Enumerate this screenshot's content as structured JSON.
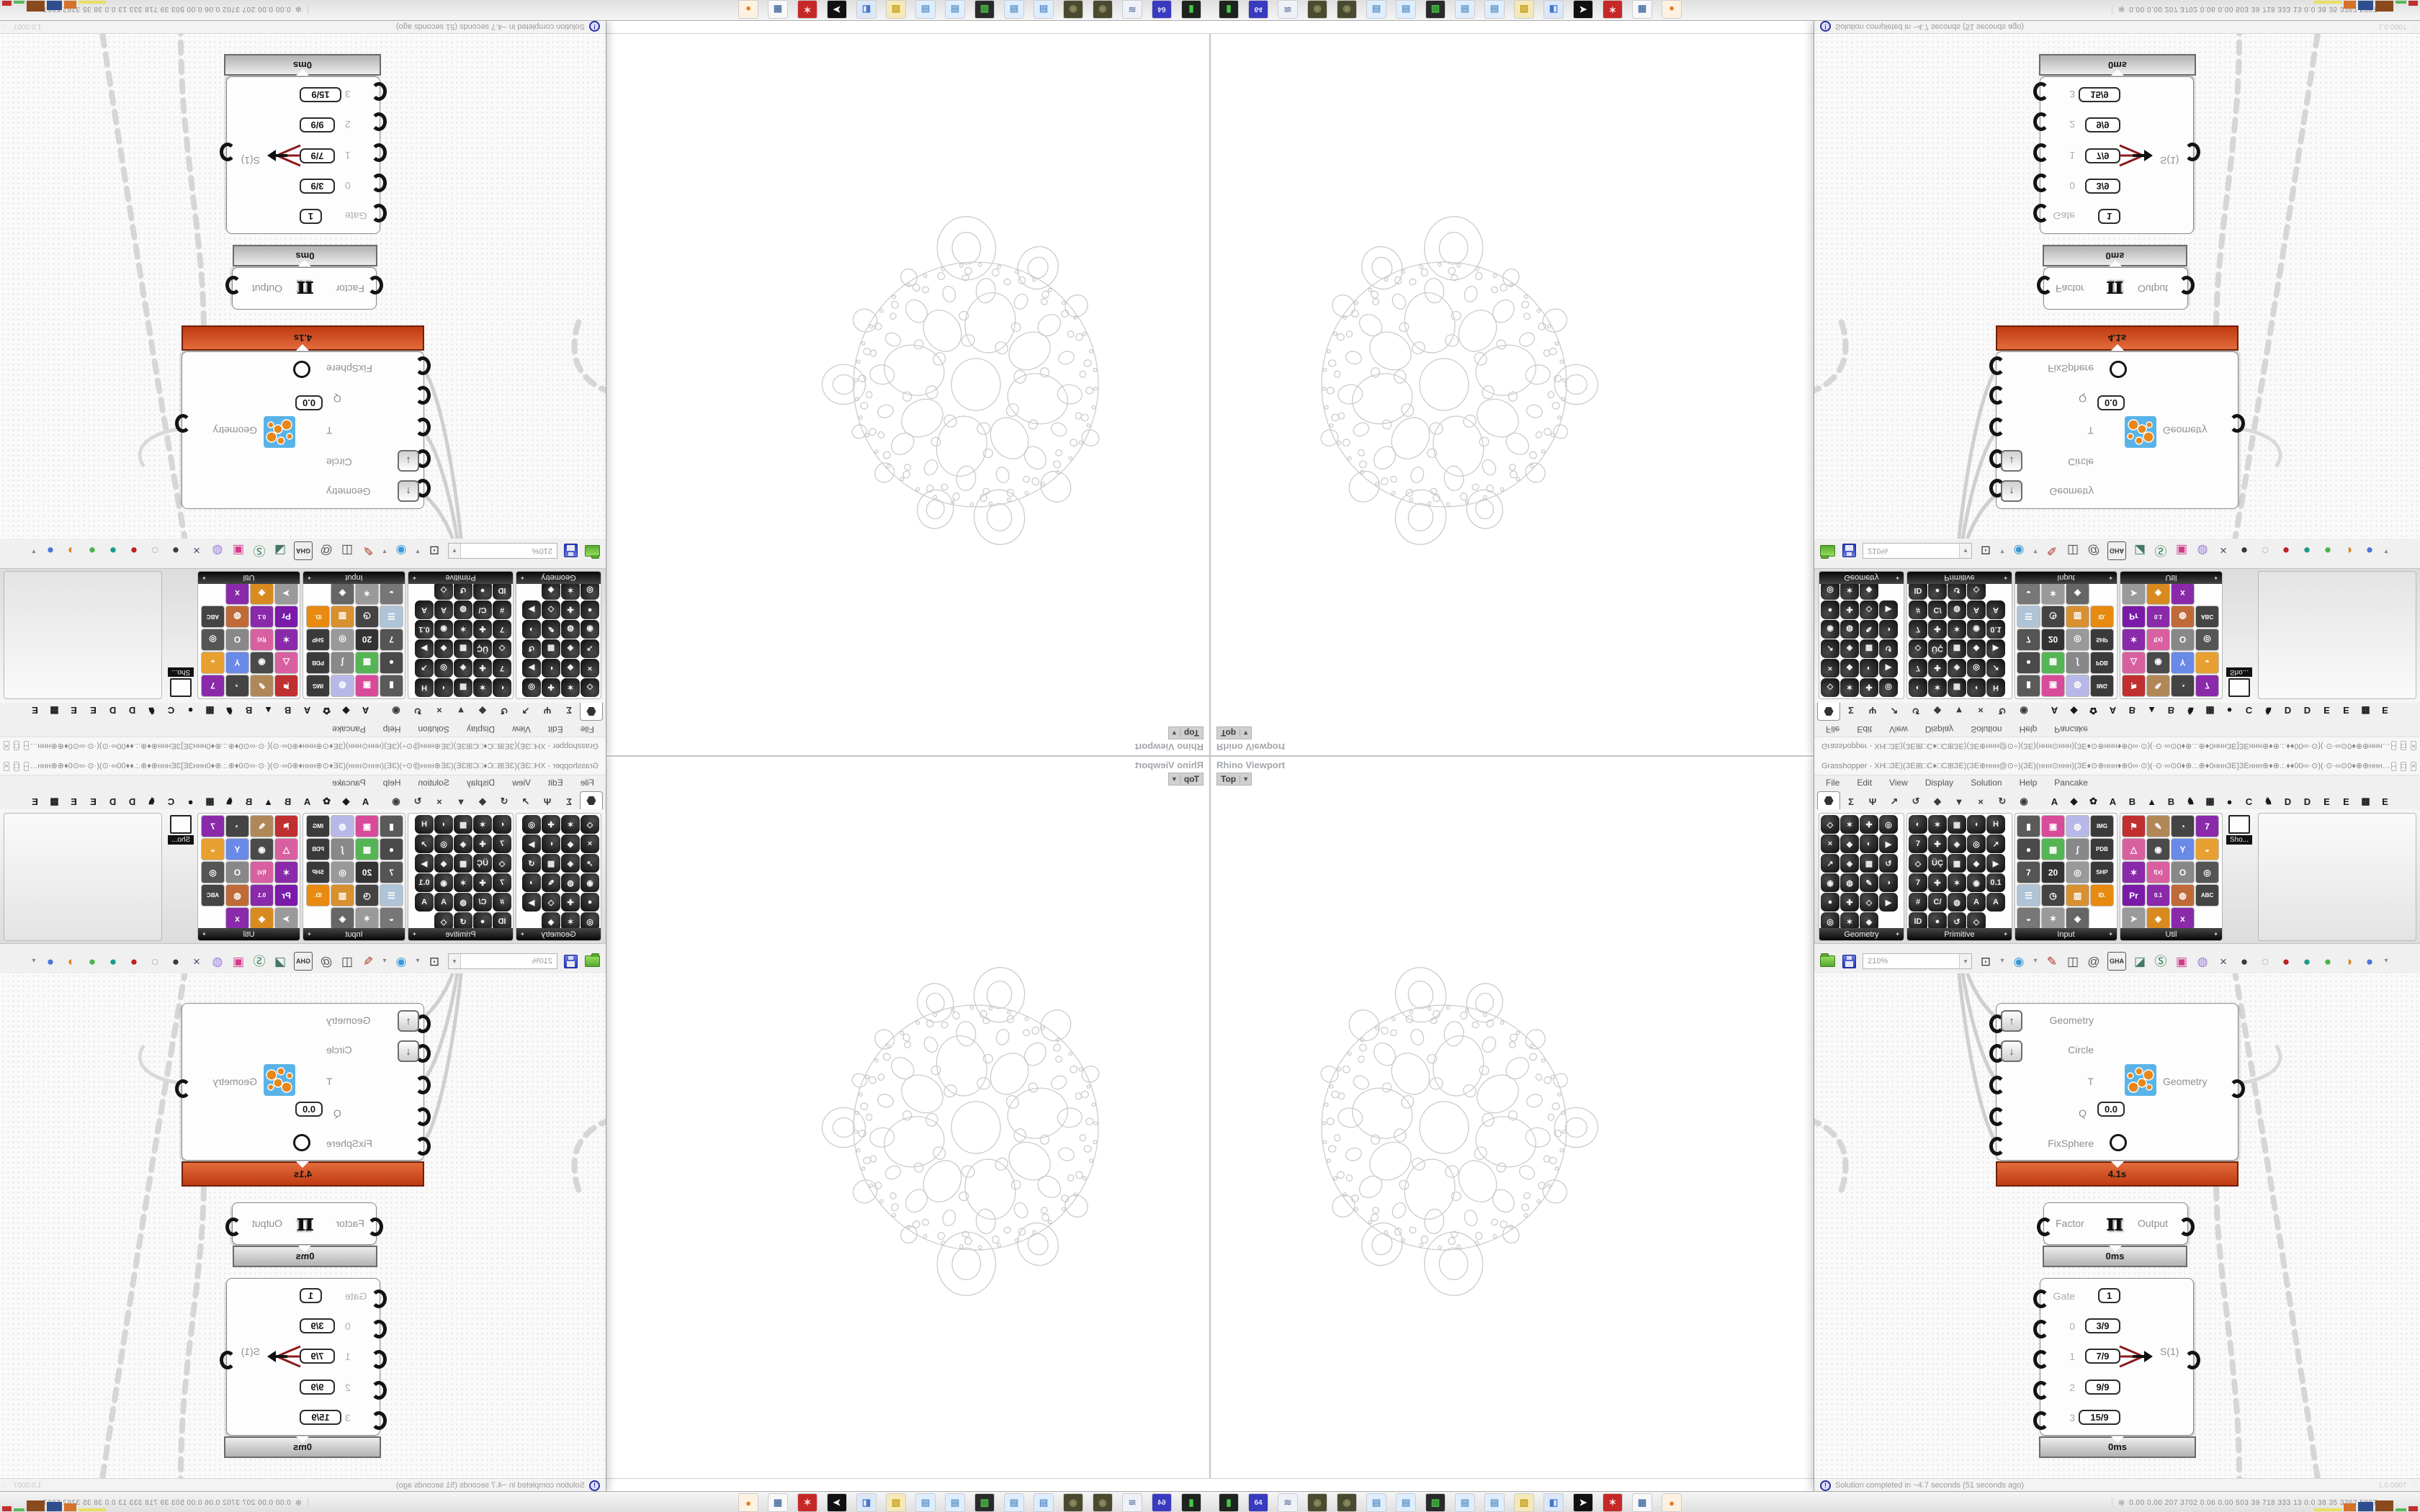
{
  "window": {
    "title": "Grasshopper - XH□ЗЕ)(ЗЕ⊞□C♦□C⊞ЗЕ)(ЗЕ⊕ннн@⊙÷)(ЗЕ)(ннн⊙ннн)(ЗЕ♦⊙⊕ннн♦⊕0∞·⊙)(·⊙·∞⊙0♦⊕.:.⊕♦0нннЗЕ]ЗЕннн⊕♦⊕.:.♦♦00∞·⊙)(·⊙·∞⊙0♦⊕⊕ннн@⊙♦)(ЗЕ)(ннн⊙ннн...",
    "controls": [
      {
        "name": "minimize-button",
        "glyph": "–"
      },
      {
        "name": "maximize-button",
        "glyph": "□"
      },
      {
        "name": "close-button",
        "glyph": "×"
      }
    ],
    "menus": [
      "File",
      "Edit",
      "View",
      "Display",
      "Solution",
      "Help",
      "Pancake"
    ]
  },
  "tabs": {
    "param_tabs": [
      {
        "name": "tab-params",
        "glyph": "hex",
        "selected": true
      },
      {
        "name": "tab-maths",
        "glyph": "Σ",
        "selected": false
      },
      {
        "name": "tab-sets",
        "glyph": "Ψ",
        "selected": false
      },
      {
        "name": "tab-vector",
        "glyph": "↗",
        "selected": false
      },
      {
        "name": "tab-curve",
        "glyph": "↺",
        "selected": false
      },
      {
        "name": "tab-surface",
        "glyph": "◆",
        "selected": false
      },
      {
        "name": "tab-mesh",
        "glyph": "▼",
        "selected": false
      },
      {
        "name": "tab-intersect",
        "glyph": "×",
        "selected": false
      },
      {
        "name": "tab-transform",
        "glyph": "↻",
        "selected": false
      },
      {
        "name": "tab-display",
        "glyph": "◉",
        "selected": false
      }
    ],
    "plugin_tabs": [
      "A",
      "◆",
      "✿",
      "A",
      "B",
      "▲",
      "B",
      "♞",
      "▦",
      "●",
      "C",
      "♞",
      "D",
      "D",
      "E",
      "E",
      "▩",
      "E"
    ]
  },
  "palette": {
    "panels": [
      {
        "label": "Geometry",
        "style": "dark",
        "x": 6,
        "w": 117,
        "count": 23,
        "glyphs": [
          "◇",
          "✶",
          "✚",
          "◎",
          "×",
          "◆",
          "◐",
          "▶",
          "↗",
          "◈",
          "▦",
          "↺",
          "◉",
          "◍",
          "✎",
          "◑",
          "●",
          "✚",
          "◇",
          "▶",
          "◎",
          "✶",
          "◆"
        ]
      },
      {
        "label": "Primitive",
        "style": "dark",
        "x": 128,
        "w": 145,
        "count": 29,
        "glyphs": [
          "◐",
          "✶",
          "▦",
          "◖",
          "H",
          "7",
          "✚",
          "◈",
          "◎",
          "↗",
          "◇",
          "ÜÇ",
          "▩",
          "◆",
          "▶",
          "7",
          "✚",
          "✶",
          "◉",
          "0.1",
          "#",
          "C/",
          "◍",
          "A",
          "A",
          "ID",
          "●",
          "↺",
          "◇"
        ]
      },
      {
        "label": "Input",
        "style": "color",
        "x": 278,
        "w": 141,
        "count": 19,
        "glyphs": [
          "▮",
          "▣",
          "◍",
          "IMG",
          "●",
          "▦",
          "∫",
          "PDB",
          "7",
          "20",
          "◎",
          "SHP",
          "☰",
          "◷",
          "▥",
          "ID.",
          "◒",
          "✶",
          "◈"
        ],
        "colors": [
          "#5a5a5a",
          "#d84a9a",
          "#b8b8e8",
          "#3a3a3a",
          "#4a4a4a",
          "#55b555",
          "#888888",
          "#3a3a3a",
          "#555555",
          "#333333",
          "#999999",
          "#3a3a3a",
          "#b0c4d8",
          "#444444",
          "#d89030",
          "#e88a10",
          "#777777",
          "#9a9a9a",
          "#666666"
        ]
      },
      {
        "label": "Util",
        "style": "color",
        "x": 424,
        "w": 141,
        "count": 19,
        "glyphs": [
          "⚑",
          "✎",
          "◔",
          "7",
          "△",
          "◉",
          "Y",
          "◒",
          "✶",
          "f(x)",
          "O",
          "◎",
          "Pr",
          "0.1",
          "◍",
          "ABC",
          "➤",
          "◈",
          "x"
        ],
        "colors": [
          "#c03030",
          "#b08858",
          "#444444",
          "#8a2aaa",
          "#d860a0",
          "#4a4a4a",
          "#6a8ae8",
          "#e8a030",
          "#8a2aaa",
          "#d860a0",
          "#888888",
          "#555555",
          "#7a1aa8",
          "#8a2aaa",
          "#c06a3a",
          "#444444",
          "#9a9a9a",
          "#d88a20",
          "#8a2aaa"
        ]
      }
    ],
    "overflow_label": "Sho...",
    "overflow_icon": "projector-screen-icon"
  },
  "toolbar": {
    "zoom_value": "210%",
    "items": [
      {
        "name": "zoom-extents-button",
        "glyph": "⊡",
        "color": "#333333"
      },
      {
        "name": "chevron-down-icon",
        "glyph": "▾",
        "color": "#888888",
        "small": true
      },
      {
        "name": "preview-eye-button",
        "glyph": "◉",
        "color": "#3a9ad8"
      },
      {
        "name": "chevron-down-icon",
        "glyph": "▾",
        "color": "#888888",
        "small": true
      },
      {
        "name": "sketch-pen-button",
        "glyph": "✎",
        "color": "#b03020"
      },
      {
        "name": "box-display-button",
        "glyph": "◫",
        "color": "#444444"
      },
      {
        "name": "remote-at-button",
        "glyph": "@",
        "color": "#555555"
      },
      {
        "name": "gha-button",
        "glyph": "GHA",
        "color": "#333333",
        "gha": true
      },
      {
        "name": "doc-capture-button",
        "glyph": "◪",
        "color": "#447766"
      },
      {
        "name": "search-button",
        "glyph": "Ⓢ",
        "color": "#2a7a4a"
      },
      {
        "name": "help-box-button",
        "glyph": "▣",
        "color": "#d23a8a"
      },
      {
        "name": "bulb-button",
        "glyph": "◍",
        "color": "#9a7ad8"
      },
      {
        "name": "wires-button",
        "glyph": "×",
        "color": "#384a6a"
      },
      {
        "name": "preview-off-button",
        "glyph": "●",
        "color": "#3a3a3a"
      },
      {
        "name": "preview-wire-button",
        "glyph": "◌",
        "color": "#8a8a8a"
      },
      {
        "name": "preview-shaded-button",
        "glyph": "●",
        "color": "#bb2222"
      },
      {
        "name": "gem-teal-button",
        "glyph": "●",
        "color": "#1a9a8a"
      },
      {
        "name": "gem-green-button",
        "glyph": "●",
        "color": "#4ab54a"
      },
      {
        "name": "gem-orange-button",
        "glyph": "◑",
        "color": "#e08020"
      },
      {
        "name": "gem-blue-button",
        "glyph": "●",
        "color": "#4a78d8"
      },
      {
        "name": "chevron-down-icon",
        "glyph": "▾",
        "color": "#888888",
        "small": true
      }
    ]
  },
  "nodes": {
    "fixsphere": {
      "inputs": [
        "Geometry",
        "Circle",
        "T",
        "Q",
        "FixSphere"
      ],
      "q_value": "0.0",
      "output_label": "Geometry",
      "profiler": "4.1s"
    },
    "pi": {
      "input": "Factor",
      "symbol": "π",
      "output": "Output",
      "profiler": "0ms"
    },
    "series": {
      "rows": [
        {
          "label": "Gate",
          "value": "1"
        },
        {
          "label": "0",
          "value": "3/9"
        },
        {
          "label": "1",
          "value": "7/9"
        },
        {
          "label": "2",
          "value": "9/9"
        },
        {
          "label": "3",
          "value": "15/9"
        }
      ],
      "output": "S(1)",
      "profiler": "0ms"
    }
  },
  "status_bar": {
    "message": "Solution completed in ~4.7 seconds (51 seconds ago)",
    "version": "1.0.0007"
  },
  "viewport": {
    "panel_title": "Rhino Viewport",
    "tab_label": "Top",
    "tab_chevron": "▾"
  },
  "taskbar": {
    "icons": [
      {
        "name": "drive-green-icon",
        "glyph": "▮",
        "bg": "#1d241d",
        "fg": "#48c848"
      },
      {
        "name": "floppy-64-icon",
        "glyph": "64",
        "bg": "#3a3ac0",
        "fg": "#e8e8f8"
      },
      {
        "name": "scroll-document-icon",
        "glyph": "≋",
        "bg": "#eef2f8",
        "fg": "#7a8aa8"
      },
      {
        "name": "dark-globe-icon",
        "glyph": "◉",
        "bg": "#4a4a30",
        "fg": "#8a8a60"
      },
      {
        "name": "dark-globe-icon",
        "glyph": "◉",
        "bg": "#4a4a30",
        "fg": "#8a8a60"
      },
      {
        "name": "notepad-icon",
        "glyph": "▤",
        "bg": "#dfeefe",
        "fg": "#6699cc"
      },
      {
        "name": "notepad-icon",
        "glyph": "▤",
        "bg": "#dfeefe",
        "fg": "#6699cc"
      },
      {
        "name": "monitor-icon",
        "glyph": "▥",
        "bg": "#2a2a2a",
        "fg": "#44cc44"
      },
      {
        "name": "notepad-icon",
        "glyph": "▤",
        "bg": "#dfeefe",
        "fg": "#6699cc"
      },
      {
        "name": "notepad-icon",
        "glyph": "▤",
        "bg": "#dfeefe",
        "fg": "#6699cc"
      },
      {
        "name": "folder-yellow-icon",
        "glyph": "▨",
        "bg": "#f5e9b8",
        "fg": "#c8a020"
      },
      {
        "name": "plug-audio-icon",
        "glyph": "◧",
        "bg": "#dce8f8",
        "fg": "#4477cc"
      },
      {
        "name": "cursor-arrow-icon",
        "glyph": "➤",
        "bg": "#111111",
        "fg": "#ffffff"
      },
      {
        "name": "red-badge-icon",
        "glyph": "✶",
        "bg": "#c62828",
        "fg": "#ffdddd"
      },
      {
        "name": "calculator-icon",
        "glyph": "▦",
        "bg": "#f8f8f8",
        "fg": "#5577aa"
      },
      {
        "name": "firefox-icon",
        "glyph": "●",
        "bg": "#fdf2e2",
        "fg": "#e87820"
      }
    ],
    "stats_glyph": "✻",
    "stats": "0.00 0.00  207 3702 0.06 0.00  503   39   718  333   13   0.0   38   35  3262 5067",
    "chart": [
      {
        "color": "#e8e060",
        "w": 38,
        "h": 4
      },
      {
        "color": "#d4722a",
        "w": 17,
        "h": 11
      },
      {
        "color": "#2e4f8e",
        "w": 21,
        "h": 13
      },
      {
        "color": "#8a4a1e",
        "w": 25,
        "h": 15
      },
      {
        "color": "#58b858",
        "w": 15,
        "h": 4
      },
      {
        "color": "#c03030",
        "w": 13,
        "h": 7
      }
    ]
  },
  "colors": {
    "profiler_red": "#c03a12",
    "wire_gray": "#d4d4d4",
    "gasket_stroke": "#c9cdce",
    "fixsphere_icon_orange": "#e8871a",
    "fixsphere_icon_blue": "#58b4e8"
  }
}
